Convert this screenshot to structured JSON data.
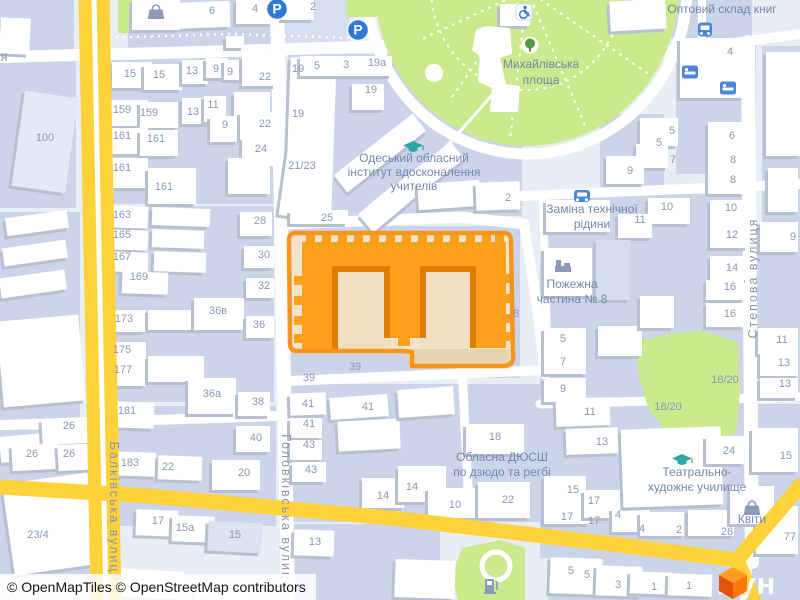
{
  "attribution": {
    "text": "© OpenMapTiles © OpenStreetMap contributors"
  },
  "logo": {
    "text": "лун",
    "cube_colors": [
      "#FF9D1F",
      "#E2540C",
      "#FB7A10"
    ]
  },
  "colors": {
    "base": "#E9EDF6",
    "block": "#CBD4E9",
    "road": "#FFFFFF",
    "main_road": "#FFD23B",
    "park": "#CBEA8E",
    "building": "#FFFFFF",
    "building_shadow": "#B8BFCE",
    "selection_stroke": "#F7941E",
    "selection_fill": "#F1E4CC",
    "selected_building": "#FFA01C",
    "selected_building_shadow": "#DE7D06",
    "courtyard": "#EFDFC0",
    "number_text": "#8A96B6",
    "poi_text": "#7486AE",
    "street_text": "#8B94AC",
    "icon_blue": "#2E79D2",
    "icon_teal": "#2EA6A2",
    "icon_gray": "#8C99B8"
  },
  "map": {
    "street_labels": [
      {
        "text": "Балківська вулиця",
        "x": 110,
        "y": 512,
        "rotate": 90
      },
      {
        "text": "Головківська вулиця",
        "x": 282,
        "y": 512,
        "rotate": 90
      },
      {
        "text": "Степова вулиця",
        "x": 757,
        "y": 278,
        "rotate": -90
      },
      {
        "text": "я",
        "x": 5,
        "y": 61,
        "rotate": 0
      }
    ],
    "poi_labels": [
      {
        "lines": [
          "Михайлівська",
          "площа"
        ],
        "x": 541,
        "y": 68,
        "lh": 16
      },
      {
        "lines": [
          "Одеський обласний",
          "інститут вдосконалення",
          "учителів"
        ],
        "x": 414,
        "y": 162,
        "lh": 14
      },
      {
        "lines": [
          "Заміна технічної",
          "рідини"
        ],
        "x": 592,
        "y": 213,
        "lh": 15
      },
      {
        "lines": [
          "Пожежна",
          "частина № 8"
        ],
        "x": 572,
        "y": 288,
        "lh": 15
      },
      {
        "lines": [
          "Обласна ДЮСШ",
          "по дзюдо та регбі"
        ],
        "x": 502,
        "y": 461,
        "lh": 15
      },
      {
        "lines": [
          "Театрально-",
          "художнє училище"
        ],
        "x": 697,
        "y": 476,
        "lh": 15
      },
      {
        "lines": [
          "Квіти"
        ],
        "x": 752,
        "y": 523,
        "lh": 14
      },
      {
        "lines": [
          "Оптовий склад книг"
        ],
        "x": 722,
        "y": 13,
        "lh": 14
      }
    ],
    "house_numbers": [
      {
        "t": "6",
        "x": 212,
        "y": 14
      },
      {
        "t": "4",
        "x": 255,
        "y": 12
      },
      {
        "t": "2",
        "x": 313,
        "y": 10
      },
      {
        "t": "15",
        "x": 130,
        "y": 77
      },
      {
        "t": "15",
        "x": 159,
        "y": 78
      },
      {
        "t": "13",
        "x": 192,
        "y": 74
      },
      {
        "t": "9",
        "x": 216,
        "y": 72
      },
      {
        "t": "9",
        "x": 230,
        "y": 75
      },
      {
        "t": "22",
        "x": 265,
        "y": 80
      },
      {
        "t": "159",
        "x": 122,
        "y": 113
      },
      {
        "t": "159",
        "x": 149,
        "y": 116
      },
      {
        "t": "13",
        "x": 193,
        "y": 115
      },
      {
        "t": "11",
        "x": 213,
        "y": 108
      },
      {
        "t": "161",
        "x": 122,
        "y": 139
      },
      {
        "t": "161",
        "x": 156,
        "y": 142
      },
      {
        "t": "9",
        "x": 225,
        "y": 128
      },
      {
        "t": "22",
        "x": 265,
        "y": 127
      },
      {
        "t": "24",
        "x": 261,
        "y": 152
      },
      {
        "t": "100",
        "x": 45,
        "y": 141
      },
      {
        "t": "161",
        "x": 122,
        "y": 171
      },
      {
        "t": "161",
        "x": 164,
        "y": 190
      },
      {
        "t": "19",
        "x": 298,
        "y": 72
      },
      {
        "t": "5",
        "x": 317,
        "y": 69
      },
      {
        "t": "3",
        "x": 346,
        "y": 68
      },
      {
        "t": "19а",
        "x": 377,
        "y": 66
      },
      {
        "t": "19",
        "x": 371,
        "y": 93
      },
      {
        "t": "19",
        "x": 298,
        "y": 117
      },
      {
        "t": "21/23",
        "x": 302,
        "y": 169
      },
      {
        "t": "25",
        "x": 327,
        "y": 221
      },
      {
        "t": "2",
        "x": 508,
        "y": 201
      },
      {
        "t": "8",
        "x": 516,
        "y": 317
      },
      {
        "t": "4",
        "x": 730,
        "y": 55
      },
      {
        "t": "5",
        "x": 672,
        "y": 134
      },
      {
        "t": "5",
        "x": 659,
        "y": 146
      },
      {
        "t": "7",
        "x": 673,
        "y": 163
      },
      {
        "t": "9",
        "x": 630,
        "y": 174
      },
      {
        "t": "6",
        "x": 732,
        "y": 139
      },
      {
        "t": "8",
        "x": 733,
        "y": 163
      },
      {
        "t": "8",
        "x": 733,
        "y": 183
      },
      {
        "t": "10",
        "x": 667,
        "y": 210
      },
      {
        "t": "10",
        "x": 731,
        "y": 211
      },
      {
        "t": "11",
        "x": 640,
        "y": 223
      },
      {
        "t": "12",
        "x": 732,
        "y": 238
      },
      {
        "t": "14",
        "x": 732,
        "y": 271
      },
      {
        "t": "16",
        "x": 730,
        "y": 290
      },
      {
        "t": "16",
        "x": 730,
        "y": 317
      },
      {
        "t": "9",
        "x": 793,
        "y": 240
      },
      {
        "t": "11",
        "x": 782,
        "y": 343
      },
      {
        "t": "13",
        "x": 784,
        "y": 366
      },
      {
        "t": "13",
        "x": 785,
        "y": 387
      },
      {
        "t": "5",
        "x": 563,
        "y": 342
      },
      {
        "t": "7",
        "x": 563,
        "y": 365
      },
      {
        "t": "9",
        "x": 563,
        "y": 392
      },
      {
        "t": "18/20",
        "x": 725,
        "y": 383
      },
      {
        "t": "18/20",
        "x": 668,
        "y": 410
      },
      {
        "t": "163",
        "x": 122,
        "y": 218
      },
      {
        "t": "165",
        "x": 122,
        "y": 238
      },
      {
        "t": "167",
        "x": 122,
        "y": 260
      },
      {
        "t": "169",
        "x": 139,
        "y": 280
      },
      {
        "t": "173",
        "x": 124,
        "y": 322
      },
      {
        "t": "175",
        "x": 122,
        "y": 353
      },
      {
        "t": "177",
        "x": 123,
        "y": 373
      },
      {
        "t": "28",
        "x": 260,
        "y": 224
      },
      {
        "t": "30",
        "x": 264,
        "y": 258
      },
      {
        "t": "32",
        "x": 264,
        "y": 289
      },
      {
        "t": "36в",
        "x": 218,
        "y": 314
      },
      {
        "t": "36",
        "x": 259,
        "y": 328
      },
      {
        "t": "36а",
        "x": 212,
        "y": 397
      },
      {
        "t": "39",
        "x": 309,
        "y": 381
      },
      {
        "t": "39",
        "x": 355,
        "y": 370
      },
      {
        "t": "41",
        "x": 308,
        "y": 407
      },
      {
        "t": "41",
        "x": 368,
        "y": 410
      },
      {
        "t": "41",
        "x": 309,
        "y": 427
      },
      {
        "t": "43",
        "x": 309,
        "y": 448
      },
      {
        "t": "43",
        "x": 311,
        "y": 473
      },
      {
        "t": "14",
        "x": 383,
        "y": 499
      },
      {
        "t": "14",
        "x": 412,
        "y": 490
      },
      {
        "t": "10",
        "x": 455,
        "y": 508
      },
      {
        "t": "22",
        "x": 508,
        "y": 503
      },
      {
        "t": "13",
        "x": 315,
        "y": 545
      },
      {
        "t": "18",
        "x": 495,
        "y": 440
      },
      {
        "t": "26",
        "x": 69,
        "y": 429
      },
      {
        "t": "26",
        "x": 32,
        "y": 457
      },
      {
        "t": "26",
        "x": 69,
        "y": 457
      },
      {
        "t": "181",
        "x": 127,
        "y": 414
      },
      {
        "t": "183",
        "x": 130,
        "y": 466
      },
      {
        "t": "22",
        "x": 168,
        "y": 470
      },
      {
        "t": "38",
        "x": 258,
        "y": 405
      },
      {
        "t": "40",
        "x": 256,
        "y": 441
      },
      {
        "t": "20",
        "x": 244,
        "y": 476
      },
      {
        "t": "23/4",
        "x": 38,
        "y": 538
      },
      {
        "t": "17",
        "x": 158,
        "y": 524
      },
      {
        "t": "15а",
        "x": 185,
        "y": 531
      },
      {
        "t": "15",
        "x": 235,
        "y": 538
      },
      {
        "t": "11",
        "x": 590,
        "y": 415
      },
      {
        "t": "13",
        "x": 602,
        "y": 445
      },
      {
        "t": "15",
        "x": 573,
        "y": 493
      },
      {
        "t": "17",
        "x": 594,
        "y": 504
      },
      {
        "t": "17",
        "x": 567,
        "y": 520
      },
      {
        "t": "17",
        "x": 594,
        "y": 524
      },
      {
        "t": "4",
        "x": 618,
        "y": 518
      },
      {
        "t": "4",
        "x": 642,
        "y": 532
      },
      {
        "t": "2",
        "x": 679,
        "y": 533
      },
      {
        "t": "26",
        "x": 727,
        "y": 535
      },
      {
        "t": "24",
        "x": 729,
        "y": 454
      },
      {
        "t": "15",
        "x": 786,
        "y": 459
      },
      {
        "t": "77",
        "x": 790,
        "y": 540
      },
      {
        "t": "5",
        "x": 571,
        "y": 574
      },
      {
        "t": "5",
        "x": 587,
        "y": 578
      },
      {
        "t": "3",
        "x": 618,
        "y": 588
      },
      {
        "t": "1",
        "x": 654,
        "y": 590
      },
      {
        "t": "1",
        "x": 689,
        "y": 589
      }
    ],
    "icons": [
      {
        "type": "parking",
        "x": 277,
        "y": 9
      },
      {
        "type": "parking",
        "x": 358,
        "y": 30
      },
      {
        "type": "bus",
        "x": 705,
        "y": 30
      },
      {
        "type": "car",
        "x": 582,
        "y": 196
      },
      {
        "type": "bed",
        "x": 690,
        "y": 72
      },
      {
        "type": "bed",
        "x": 728,
        "y": 88
      },
      {
        "type": "grad-cap",
        "x": 413,
        "y": 147
      },
      {
        "type": "grad-cap",
        "x": 682,
        "y": 460
      },
      {
        "type": "shop-bag",
        "x": 156,
        "y": 11
      },
      {
        "type": "shop-bag",
        "x": 752,
        "y": 507
      },
      {
        "type": "fire-station",
        "x": 563,
        "y": 266
      },
      {
        "type": "fuel",
        "x": 490,
        "y": 586
      },
      {
        "type": "tree",
        "x": 530,
        "y": 45
      },
      {
        "type": "wheelchair",
        "x": 524,
        "y": 12
      }
    ]
  }
}
